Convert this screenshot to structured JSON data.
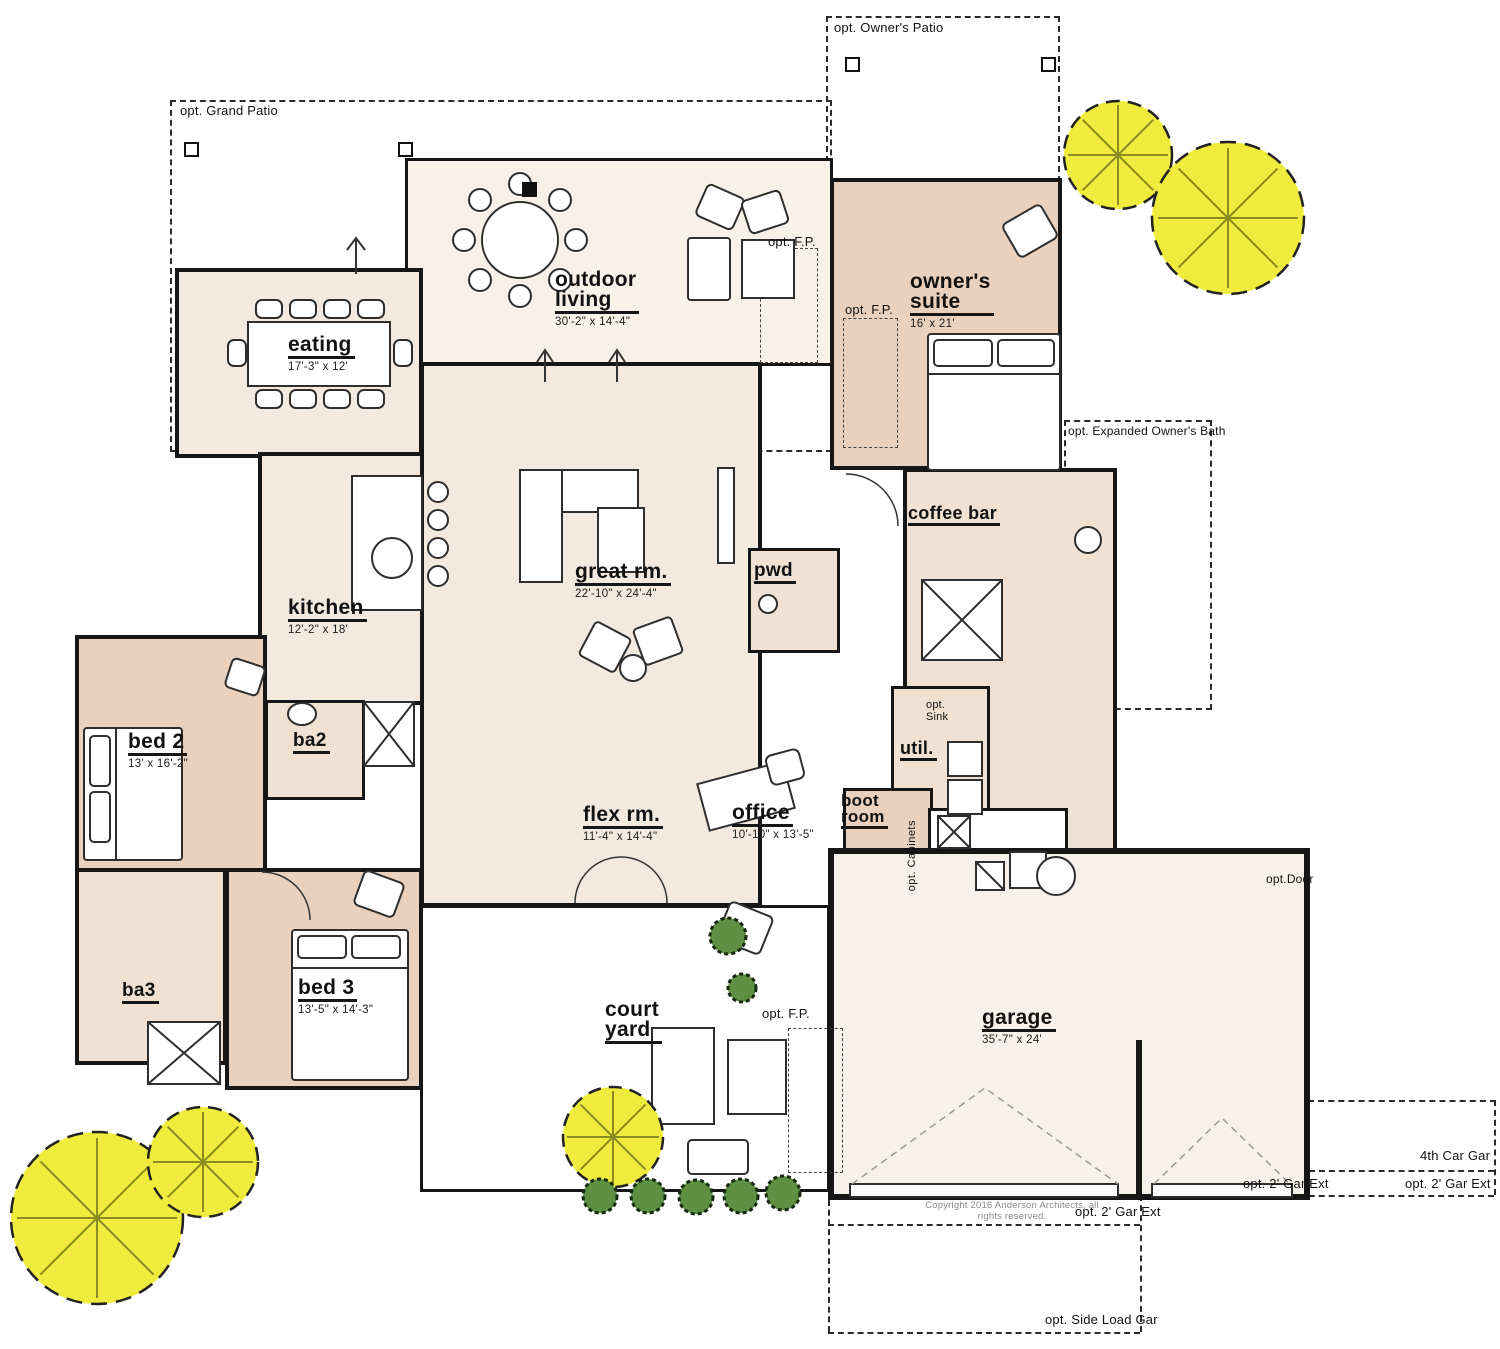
{
  "colors": {
    "wall": "#161616",
    "cream": "#f3e9de",
    "creamlt": "#f8f1e8",
    "tan": "#e9d1bd",
    "tanlt": "#f0e1d3",
    "garage": "#f6f1ea",
    "dash": "#2b2b2b",
    "treefill": "#f0ec3d",
    "treeline": "#8b8b22",
    "shrub": "#5d9040"
  },
  "copyright": "Copyright 2016 Anderson Architects, all rights reserved.",
  "rooms": {
    "outdoor_living": {
      "name": "outdoor\nliving",
      "dims": "30'-2\" x 14'-4\""
    },
    "owners_suite": {
      "name": "owner's\nsuite",
      "dims": "16' x 21'"
    },
    "eating": {
      "name": "eating",
      "dims": "17'-3\" x 12'"
    },
    "great_rm": {
      "name": "great rm.",
      "dims": "22'-10\" x 24'-4\""
    },
    "kitchen": {
      "name": "kitchen",
      "dims": "12'-2\" x 18'"
    },
    "pwd": {
      "name": "pwd"
    },
    "coffee_bar": {
      "name": "coffee bar"
    },
    "bed2": {
      "name": "bed 2",
      "dims": "13' x 16'-2\""
    },
    "ba2": {
      "name": "ba2"
    },
    "util": {
      "name": "util."
    },
    "flex_rm": {
      "name": "flex rm.",
      "dims": "11'-4\" x 14'-4\""
    },
    "office": {
      "name": "office",
      "dims": "10'-10\" x 13'-5\""
    },
    "boot_room": {
      "name": "boot\nroom"
    },
    "bed3": {
      "name": "bed 3",
      "dims": "13'-5\" x 14'-3\""
    },
    "ba3": {
      "name": "ba3"
    },
    "court_yard": {
      "name": "court\nyard"
    },
    "garage": {
      "name": "garage",
      "dims": "35'-7\" x 24'"
    }
  },
  "options": {
    "grand_patio": "opt. Grand Patio",
    "owners_patio": "opt. Owner's Patio",
    "expanded_owners_bath": "opt. Expanded Owner's Bath",
    "fp": "opt. F.P.",
    "sink": "opt.\nSink",
    "cabinets": "opt. Cabinets",
    "door": "opt.Door",
    "fourth_car": "4th Car Gar",
    "gar_ext": "opt. 2' Gar Ext",
    "side_load": "opt. Side Load Gar"
  }
}
